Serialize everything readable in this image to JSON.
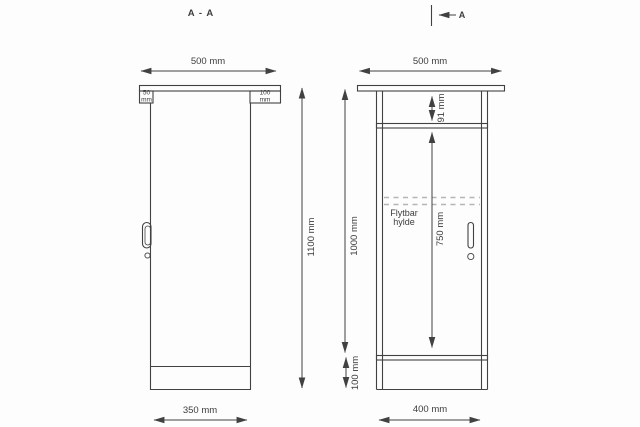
{
  "drawing": {
    "type": "technical-drawing",
    "subject": "cabinet / podium with countertop, two orthographic views",
    "left_view": {
      "title": "A - A",
      "width_label": "500 mm",
      "overhang_left_label": "50 mm",
      "overhang_right_label": "100 mm",
      "height_label": "1100 mm",
      "bottom_width_label": "350 mm"
    },
    "right_view": {
      "section_label": "A",
      "width_label": "500 mm",
      "top_gap_label": "91 mm",
      "shelf_label": "Flytbar\nhylde",
      "shelf_height_label": "750 mm",
      "height_label": "1000 mm",
      "plinth_label": "100 mm",
      "bottom_width_label": "400 mm"
    },
    "colors": {
      "line": "#414141",
      "dash": "#b5b5b5",
      "text": "#3d3d3d",
      "background": "#fdfdfd"
    }
  }
}
